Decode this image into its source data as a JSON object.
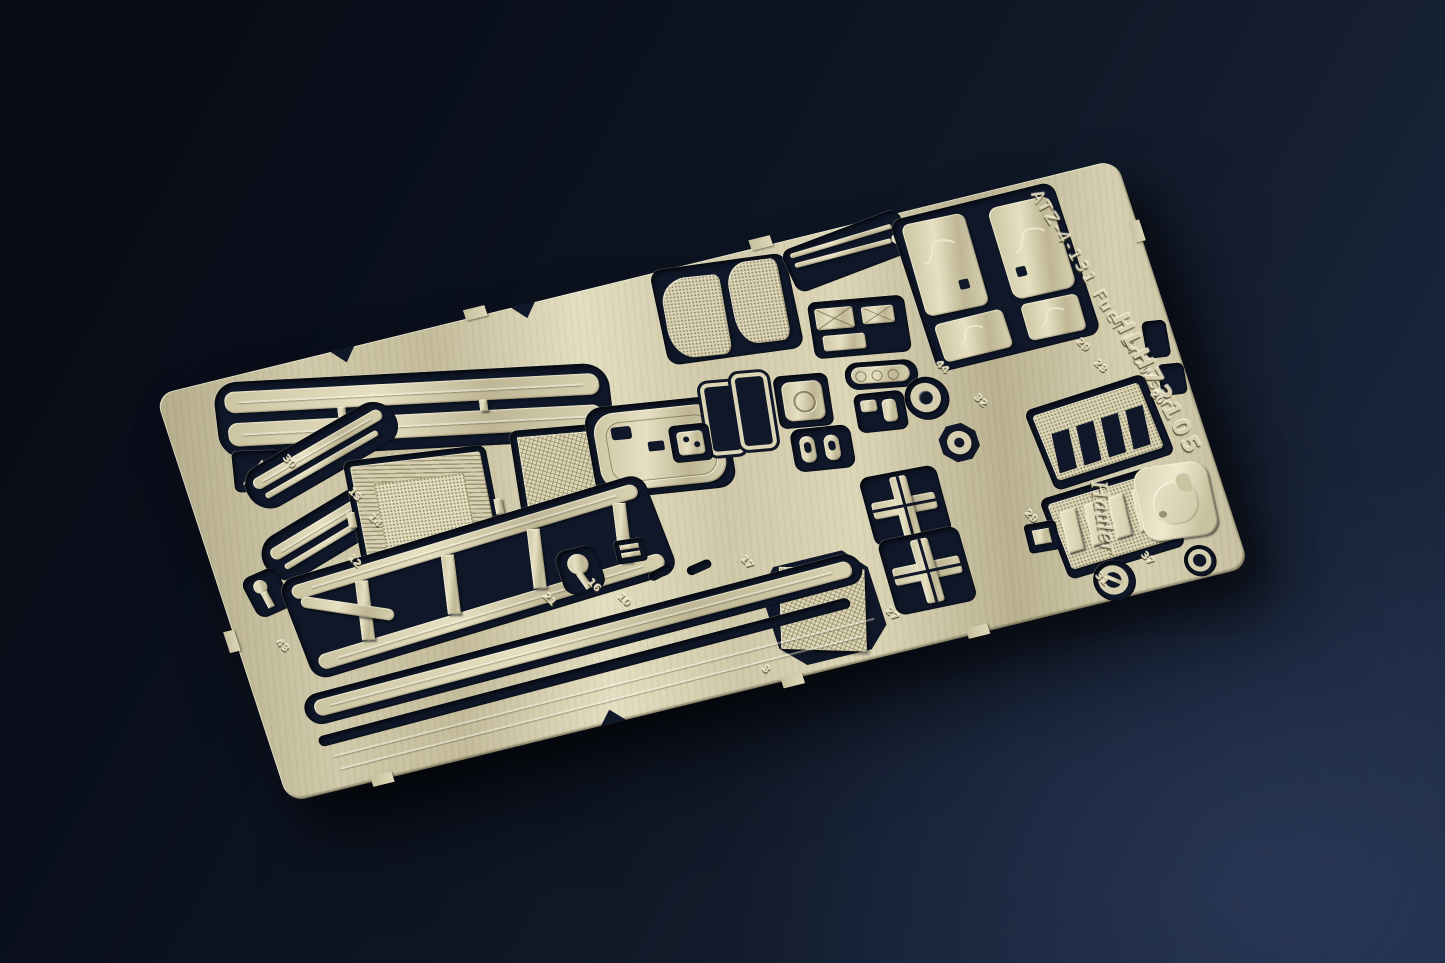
{
  "photo": {
    "background_top_left": "#070b14",
    "background_bottom_right": "#1e2b44",
    "brass": "#cdc6a6",
    "brass_light": "#e6e0c2",
    "brass_dark": "#a99f7e",
    "cutout": "#0f1728"
  },
  "fret": {
    "title": "ATZ-4-131 Fuel Browser",
    "product_code": "HLH72105",
    "brand": "Hauler",
    "logo": "hauler-dog-emblem",
    "part_numbers": [
      "30",
      "13",
      "14",
      "12",
      "43",
      "21",
      "16",
      "10",
      "3",
      "17",
      "44",
      "32",
      "27",
      "29",
      "23",
      "20",
      "29",
      "31",
      "37"
    ]
  }
}
